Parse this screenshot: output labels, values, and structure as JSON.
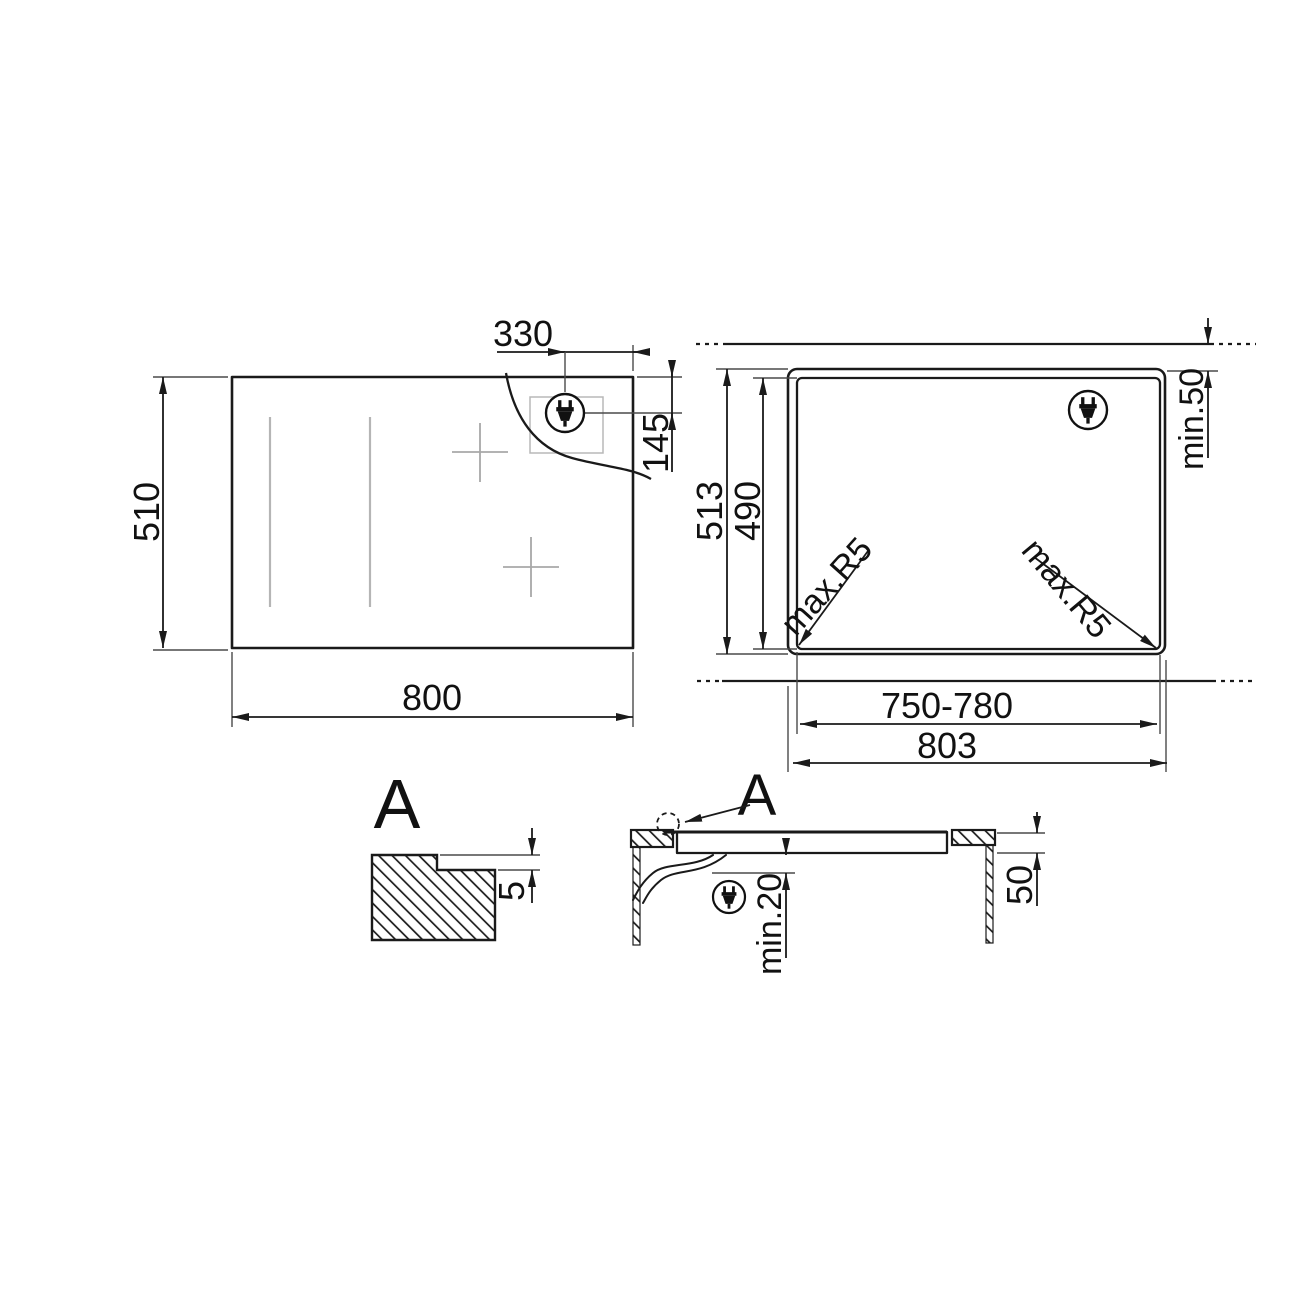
{
  "top_view": {
    "width": "800",
    "height": "510",
    "plug_offset": "330",
    "plug_inset": "145"
  },
  "cutout_view": {
    "outer_height": "513",
    "cutout_height": "490",
    "rear_clearance": "min.50",
    "radius_left": "max.R5",
    "radius_right": "max.R5",
    "cutout_width": "750-780",
    "outer_width": "803"
  },
  "detail_view": {
    "label": "A",
    "step_depth": "5"
  },
  "section_view": {
    "label": "A",
    "bottom_clearance": "min.20",
    "worktop_thickness": "50"
  }
}
